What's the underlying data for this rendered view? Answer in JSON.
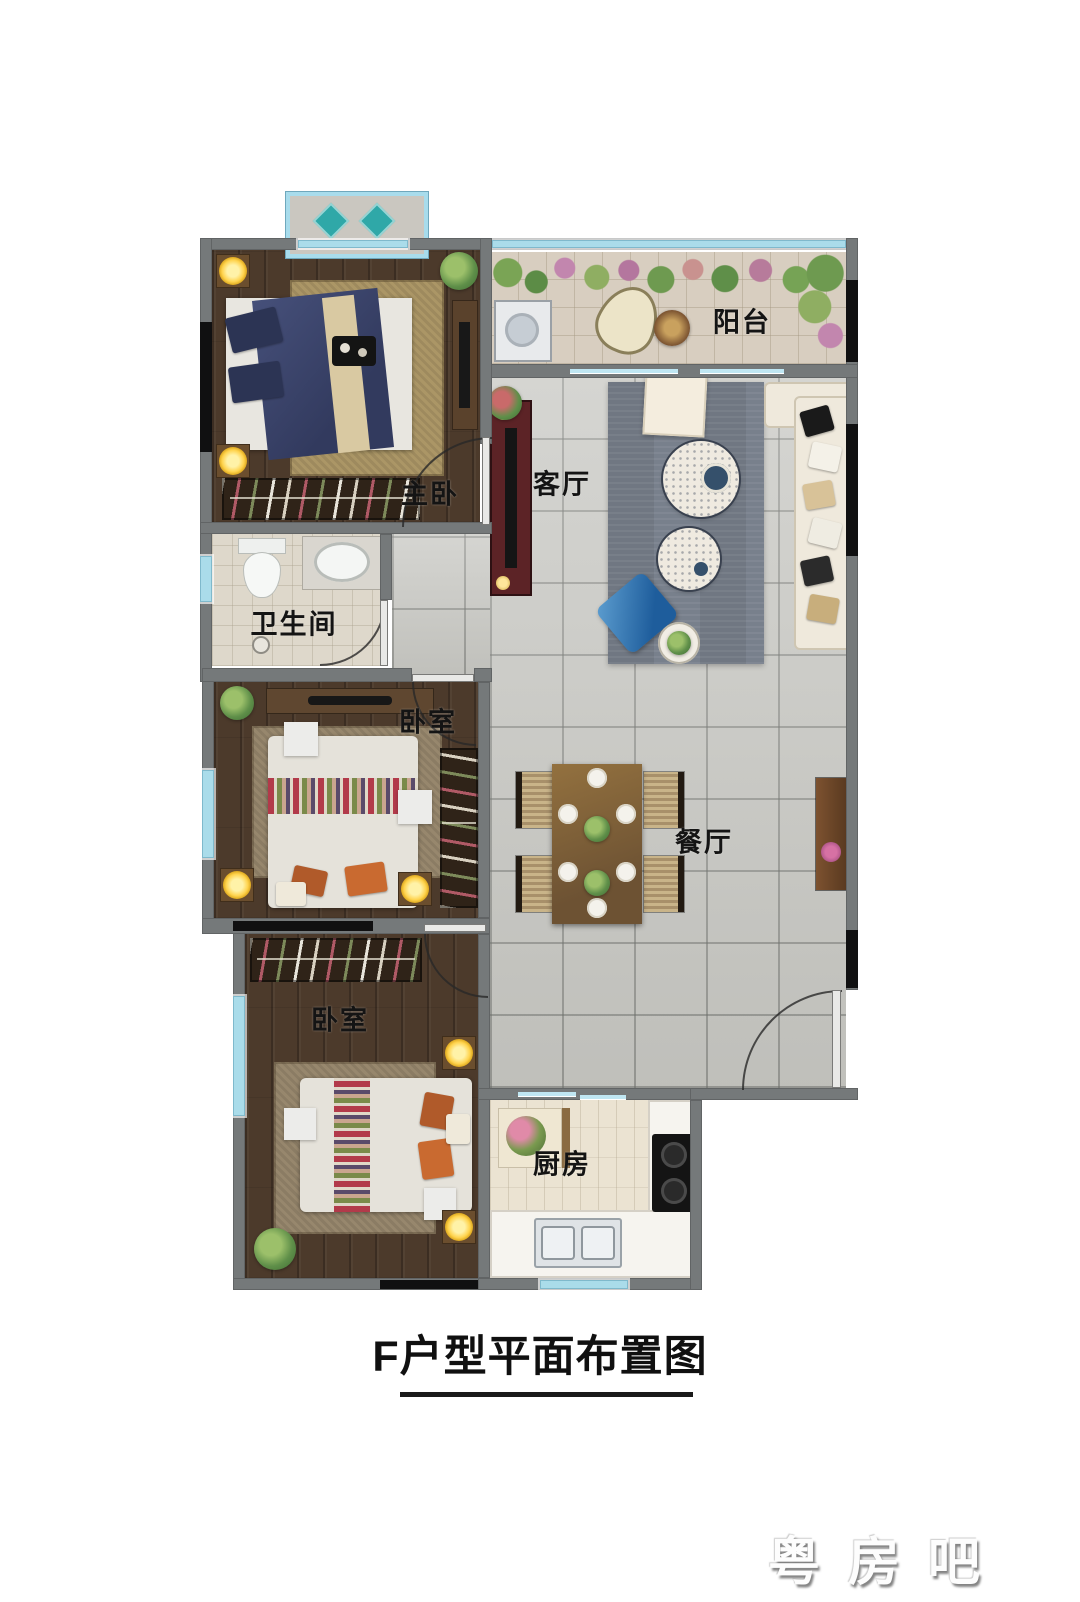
{
  "title": {
    "text": "F户型平面布置图"
  },
  "watermark": {
    "text": "粤房吧"
  },
  "rooms": {
    "balcony": {
      "label": "阳台"
    },
    "living_room": {
      "label": "客厅"
    },
    "master_bedroom": {
      "label": "主卧"
    },
    "bathroom": {
      "label": "卫生间"
    },
    "bedroom_middle": {
      "label": "卧室"
    },
    "dining_room": {
      "label": "餐厅"
    },
    "bedroom_bottom": {
      "label": "卧室"
    },
    "kitchen": {
      "label": "厨房"
    }
  },
  "colors": {
    "wall": "#75797a",
    "window_glass": "#aadcea",
    "wood_floor": "#4c3a2b",
    "stone_tile": "#c7c7c2",
    "master_bed_blue": "#3e4566",
    "sofa_cream": "#efe9dc",
    "accent_chair_blue": "#2e6fad",
    "lamp_glow": "#ffd34d",
    "title_text": "#101010"
  }
}
